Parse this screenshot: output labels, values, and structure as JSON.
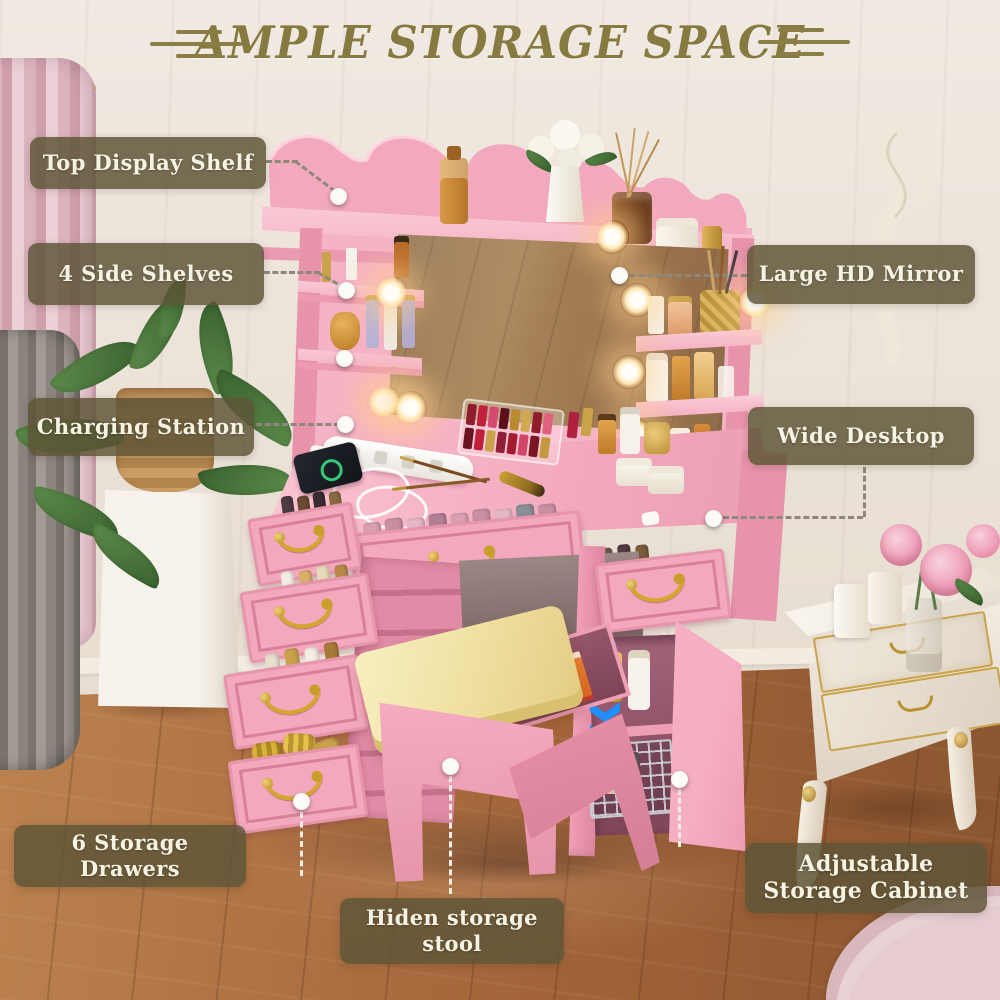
{
  "page": {
    "kind": "product-feature-infographic",
    "product": "pink vanity makeup desk with lighted mirror"
  },
  "title": {
    "text": "AMPLE STORAGE SPACE"
  },
  "callouts": {
    "top_shelf": {
      "text": "Top Display Shelf"
    },
    "side_shelves": {
      "text": "4 Side Shelves"
    },
    "charging_station": {
      "text": "Charging Station"
    },
    "mirror": {
      "text": "Large HD Mirror"
    },
    "desktop": {
      "text": "Wide Desktop"
    },
    "drawers": {
      "text": "6 Storage Drawers"
    },
    "stool": {
      "text": "Hiden storage stool"
    },
    "cabinet": {
      "text": "Adjustable Storage Cabinet"
    }
  },
  "colors": {
    "label_bg": "#5e5537",
    "label_text": "#f7f3e4",
    "title_text": "#877a40",
    "leader_line": "#8f877a",
    "leader_line_light": "#f1ede2",
    "vanity_pink": "#f2a6ba",
    "cushion_yellow": "#f2e3a8",
    "adjust_arrows_blue": "#1f8fff",
    "wood_floor": "#a9733f",
    "wall_cream": "#ece4d9"
  },
  "icons": {
    "callout_dot": "white-circle-marker",
    "adjust_up": "triple-chevron-up",
    "adjust_down": "triple-chevron-down"
  }
}
